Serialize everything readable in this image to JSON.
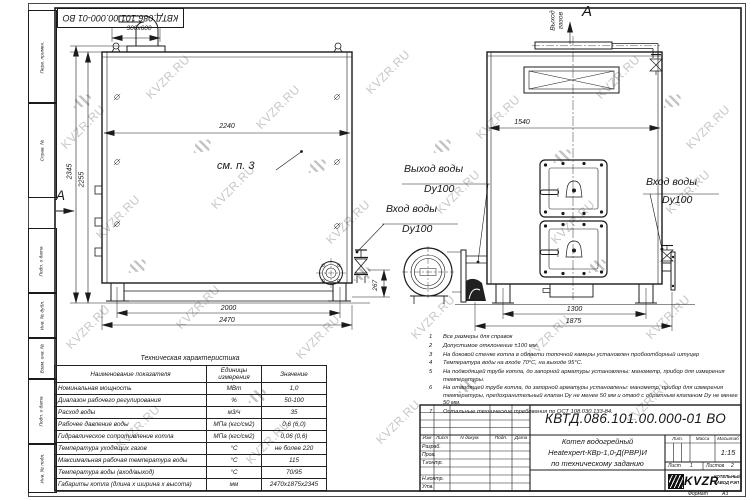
{
  "watermark": {
    "text": "KVZR.RU"
  },
  "frame": {
    "top_stamp": "КВТД.086.101.00.000-01 ВО",
    "margin_labels": [
      "Перв. примен.",
      "Справ. №",
      "Подп. и дата",
      "Инв. № дубл.",
      "Взам. инв. №",
      "Подп. и дата",
      "Инв. № подл."
    ],
    "format_label": "Формат",
    "format_value": "А3"
  },
  "drawing": {
    "labels": {
      "duct_size": "300x600",
      "section_arrow": "А",
      "view_title": "А",
      "gas_outlet_1": "Выход",
      "gas_outlet_2": "газов",
      "see_note": "см. п. 3",
      "water_out": "Выход воды",
      "water_out_dn": "Dy100",
      "water_in_mid": "Вход воды",
      "water_in_mid_dn": "Dy100",
      "water_in_right": "Вход воды",
      "water_in_right_dn": "Dy100"
    },
    "dims": {
      "side_top_width": "2240",
      "side_height_overall": "2345",
      "side_height_body": "2255",
      "side_base": "2000",
      "side_overall": "2470",
      "valve_offset": "267",
      "front_width": "1540",
      "front_base": "1300",
      "front_overall": "1875"
    }
  },
  "tech_table": {
    "title": "Техническая характеристика",
    "headers": [
      "Наименование показателя",
      "Единицы измерения",
      "Значение"
    ],
    "rows": [
      {
        "name": "Номинальная мощность",
        "unit": "МВт",
        "value": "1,0"
      },
      {
        "name": "Диапазон рабочего регулирования",
        "unit": "%",
        "value": "50-100"
      },
      {
        "name": "Расход воды",
        "unit": "м3/ч",
        "value": "35"
      },
      {
        "name": "Рабочее давление воды",
        "unit": "МПа (кгс/см2)",
        "value": "0,6 (6,0)"
      },
      {
        "name": "Гидравлическое сопротивление котла",
        "unit": "МПа (кгс/см2)",
        "value": "0,06 (0,6)"
      },
      {
        "name": "Температура уходящих газов",
        "unit": "°С",
        "value": "не более 220"
      },
      {
        "name": "Максимальная рабочая температура воды",
        "unit": "°С",
        "value": "115"
      },
      {
        "name": "Температура воды (вход/выход)",
        "unit": "°С",
        "value": "70/95"
      },
      {
        "name": "Габариты котла (длина х ширина х высота)",
        "unit": "мм",
        "value": "2470х1875х2345"
      }
    ]
  },
  "notes": [
    {
      "num": "1",
      "text": "Все размеры для справок"
    },
    {
      "num": "2",
      "text": "Допустимое отклонение ±100 мм."
    },
    {
      "num": "3",
      "text": "На боковой стенке котла в области топочной камеры установлен пробоотборный штуцер"
    },
    {
      "num": "4",
      "text": "Температура воды на входе 70°С, на выходе 95°С."
    },
    {
      "num": "5",
      "text": "На подводящей трубе котла, до запорной арматуры установлены: манометр, прибор для измерения температуры."
    },
    {
      "num": "6",
      "text": "На отводящей трубе котла, до запорной арматуры установлены: манометр, прибор для измерения температуры, предохранительный клапан Dу не менее 50 мм и отвод с обратным клапаном Dу не менее 50 мм."
    },
    {
      "num": "7",
      "text": "Остальные технические требования по ОСТ 108.030.133-84."
    }
  ],
  "title_block": {
    "designation": "КВТД.086.101.00.000-01 ВО",
    "rev_headers": {
      "izm": "Изм",
      "list": "Лист",
      "doc": "N докум.",
      "podp": "Подп.",
      "data": "Дата"
    },
    "staff": [
      "Разраб.",
      "Пров.",
      "Т.контр.",
      "",
      "Н.контр.",
      "Утв."
    ],
    "name_line1": "Котел водогрейный",
    "name_line2": "Heatexpert-КВр-1,0-Д(РВР)И",
    "name_line3": "по техническому заданию",
    "lit_label": "Лит.",
    "mass_label": "Масса",
    "scale_label": "Масштаб",
    "scale_value": "1:15",
    "sheet_label": "Лист",
    "sheet_value": "1",
    "sheets_label": "Листов",
    "sheets_value": "2",
    "company": {
      "logo": "KVZR",
      "line1": "КОТЕЛЬНЫЙ",
      "line2": "ЗАВОД РЭП"
    }
  }
}
